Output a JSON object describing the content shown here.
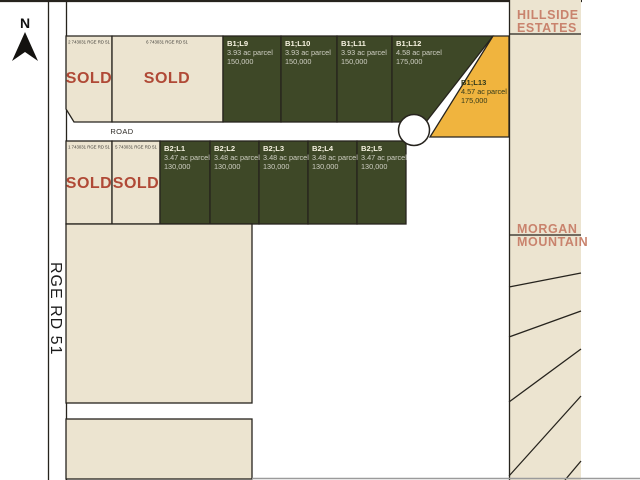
{
  "colors": {
    "beige": "#ece4d0",
    "green": "#3e4827",
    "orange": "#f0b43e",
    "border": "#26231d",
    "sold_red": "#b04936",
    "salmon": "#c9836d",
    "lot_title_text": "#f8f4e2",
    "lot_body_text": "#cfcfc3",
    "orange_lot_text": "#333a1b",
    "plan_text": "#3c3a35",
    "gray_line": "#9b9b9b"
  },
  "compass": {
    "label": "N"
  },
  "roads": {
    "vertical": "RGE RD 51",
    "horizontal": "ROAD"
  },
  "neighbors": {
    "hillside_line1": "HILLSIDE",
    "hillside_line2": "ESTATES",
    "morgan_line1": "MORGAN",
    "morgan_line2": "MOUNTAIN"
  },
  "block1": {
    "sold": [
      {
        "plan": "2 743031 RGE RD 51",
        "status": "SOLD"
      },
      {
        "plan": "6 743031 RGE RD 51",
        "status": "SOLD"
      }
    ],
    "lots": [
      {
        "id": "B1;L9",
        "size": "3.93 ac parcel",
        "price": "150,000"
      },
      {
        "id": "B1;L10",
        "size": "3.93 ac parcel",
        "price": "150,000"
      },
      {
        "id": "B1;L11",
        "size": "3.93 ac parcel",
        "price": "150,000"
      },
      {
        "id": "B1;L12",
        "size": "4.58 ac parcel",
        "price": "175,000"
      },
      {
        "id": "B1;L13",
        "size": "4.57 ac parcel",
        "price": "175,000"
      }
    ]
  },
  "block2": {
    "sold": [
      {
        "plan": "1 743031 RGE RD 51",
        "status": "SOLD"
      },
      {
        "plan": "5 743031 RGE RD 51",
        "status": "SOLD"
      }
    ],
    "lots": [
      {
        "id": "B2;L1",
        "size": "3.47 ac parcel",
        "price": "130,000"
      },
      {
        "id": "B2;L2",
        "size": "3.48 ac parcel",
        "price": "130,000"
      },
      {
        "id": "B2;L3",
        "size": "3.48 ac parcel",
        "price": "130,000"
      },
      {
        "id": "B2;L4",
        "size": "3.48 ac parcel",
        "price": "130,000"
      },
      {
        "id": "B2;L5",
        "size": "3.47 ac parcel",
        "price": "130,000"
      }
    ]
  }
}
